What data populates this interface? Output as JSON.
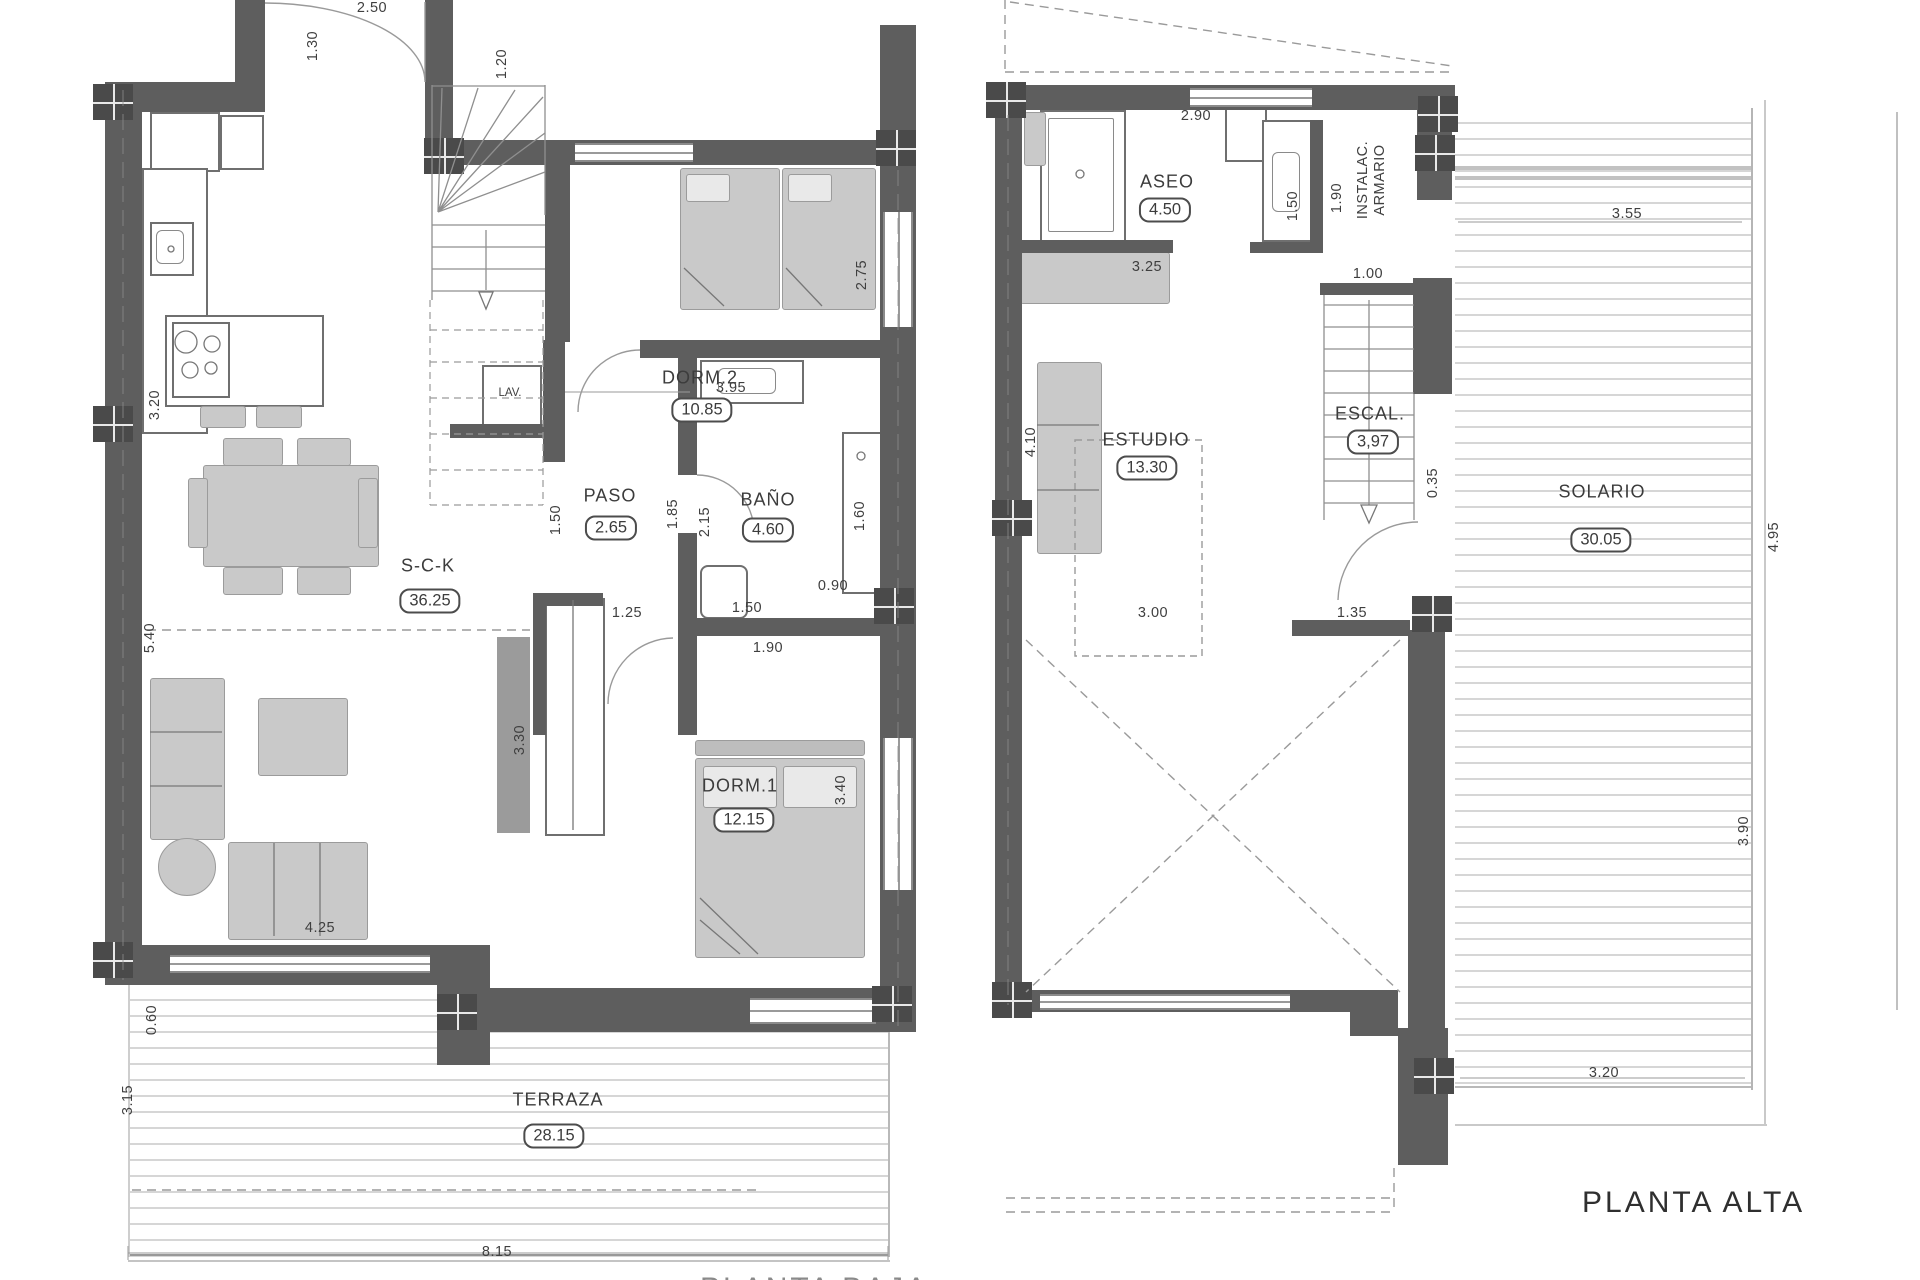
{
  "floor_titles": {
    "alta": "PLANTA ALTA",
    "baja_partial": "PLANTA BAJA"
  },
  "rooms": [
    {
      "name": "S-C-K",
      "area": "36.25",
      "cx": 428,
      "cy": 566,
      "bcx": 430,
      "bcy": 601
    },
    {
      "name": "PASO",
      "area": "2.65",
      "cx": 610,
      "cy": 496,
      "bcx": 611,
      "bcy": 528
    },
    {
      "name": "BAÑO",
      "area": "4.60",
      "cx": 768,
      "cy": 500,
      "bcx": 768,
      "bcy": 530
    },
    {
      "name": "DORM.2",
      "area": "10.85",
      "cx": 700,
      "cy": 378,
      "bcx": 702,
      "bcy": 410
    },
    {
      "name": "DORM.1",
      "area": "12.15",
      "cx": 740,
      "cy": 786,
      "bcx": 744,
      "bcy": 820
    },
    {
      "name": "TERRAZA",
      "area": "28.15",
      "cx": 558,
      "cy": 1100,
      "bcx": 554,
      "bcy": 1136
    },
    {
      "name": "ASEO",
      "area": "4.50",
      "cx": 1167,
      "cy": 182,
      "bcx": 1165,
      "bcy": 210
    },
    {
      "name": "ESTUDIO",
      "area": "13.30",
      "cx": 1146,
      "cy": 440,
      "bcx": 1147,
      "bcy": 468
    },
    {
      "name": "ESCAL.",
      "area": "3,97",
      "cx": 1370,
      "cy": 414,
      "bcx": 1373,
      "bcy": 442
    },
    {
      "name": "SOLARIO",
      "area": "30.05",
      "cx": 1602,
      "cy": 492,
      "bcx": 1601,
      "bcy": 540
    }
  ],
  "dims": [
    {
      "v": "2.50",
      "x": 372,
      "y": 8
    },
    {
      "v": "1.30",
      "x": 313,
      "y": 46,
      "r": 1
    },
    {
      "v": "1.20",
      "x": 502,
      "y": 64,
      "r": 1
    },
    {
      "v": "3.20",
      "x": 155,
      "y": 405,
      "r": 1
    },
    {
      "v": "5.40",
      "x": 150,
      "y": 638,
      "r": 1
    },
    {
      "v": "3.95",
      "x": 731,
      "y": 388
    },
    {
      "v": "1.50",
      "x": 556,
      "y": 520,
      "r": 1
    },
    {
      "v": "1.85",
      "x": 673,
      "y": 514,
      "r": 1
    },
    {
      "v": "2.15",
      "x": 705,
      "y": 522,
      "r": 1
    },
    {
      "v": "2.75",
      "x": 862,
      "y": 275,
      "r": 1
    },
    {
      "v": "1.25",
      "x": 627,
      "y": 613
    },
    {
      "v": "1.50",
      "x": 747,
      "y": 608
    },
    {
      "v": "1.90",
      "x": 768,
      "y": 648
    },
    {
      "v": "0.90",
      "x": 833,
      "y": 586
    },
    {
      "v": "1.60",
      "x": 860,
      "y": 516,
      "r": 1
    },
    {
      "v": "3.30",
      "x": 520,
      "y": 740,
      "r": 1
    },
    {
      "v": "3.40",
      "x": 841,
      "y": 790,
      "r": 1
    },
    {
      "v": "4.25",
      "x": 320,
      "y": 928
    },
    {
      "v": "0.60",
      "x": 152,
      "y": 1020,
      "r": 1
    },
    {
      "v": "3.15",
      "x": 128,
      "y": 1100,
      "r": 1
    },
    {
      "v": "8.15",
      "x": 497,
      "y": 1252
    },
    {
      "v": "2.90",
      "x": 1196,
      "y": 116
    },
    {
      "v": "1.50",
      "x": 1293,
      "y": 206,
      "r": 1
    },
    {
      "v": "1.90",
      "x": 1337,
      "y": 198,
      "r": 1
    },
    {
      "v": "3.25",
      "x": 1147,
      "y": 267
    },
    {
      "v": "1.00",
      "x": 1368,
      "y": 274
    },
    {
      "v": "4.10",
      "x": 1031,
      "y": 442,
      "r": 1
    },
    {
      "v": "3.00",
      "x": 1153,
      "y": 613
    },
    {
      "v": "1.35",
      "x": 1352,
      "y": 613
    },
    {
      "v": "3.55",
      "x": 1627,
      "y": 214
    },
    {
      "v": "4.95",
      "x": 1774,
      "y": 537,
      "r": 1
    },
    {
      "v": "0.35",
      "x": 1433,
      "y": 483,
      "r": 1
    },
    {
      "v": "3.90",
      "x": 1744,
      "y": 831,
      "r": 1
    },
    {
      "v": "3.20",
      "x": 1604,
      "y": 1073
    }
  ],
  "small_labels": [
    {
      "t": "LAV.",
      "x": 510,
      "y": 393
    },
    {
      "t": "INSTALAC.",
      "t2": "ARMARIO",
      "x": 1372,
      "y": 180,
      "r": 1
    }
  ]
}
